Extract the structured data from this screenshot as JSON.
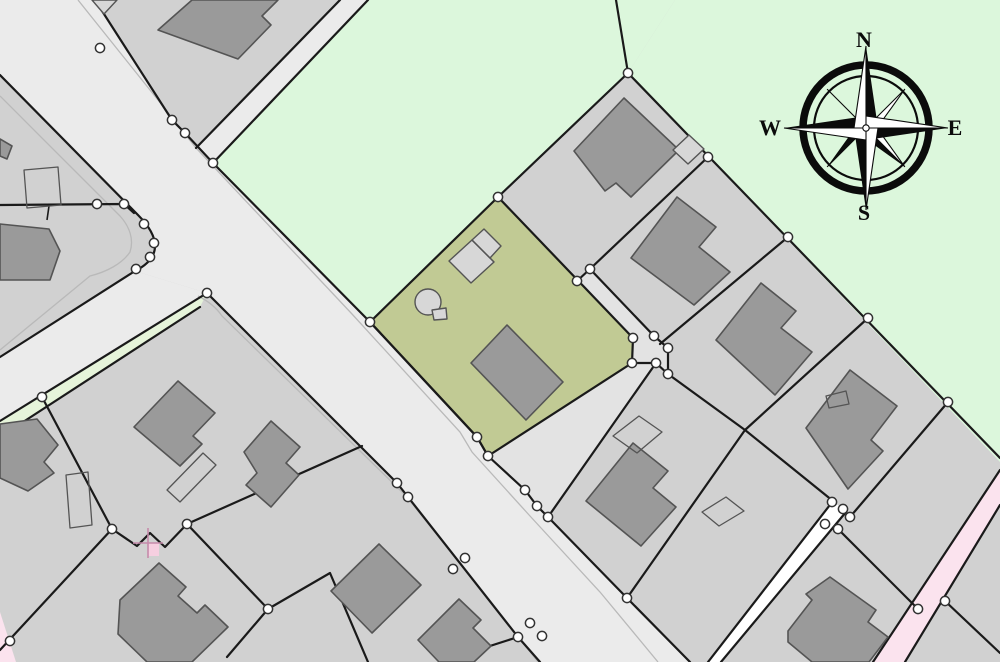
{
  "map": {
    "compass": {
      "north": "N",
      "east": "E",
      "south": "S",
      "west": "W"
    },
    "colors": {
      "parcel": "#d1d1d1",
      "parcel_line": "#1a1a1a",
      "field_green": "#dcf7dc",
      "verge_green": "#e6f4da",
      "selected_olive": "#c1ca94",
      "road": "#ebebeb",
      "lane": "#e3e3e3",
      "curb": "#b9b9b9",
      "building": "#9a9a9a",
      "building_line": "#545454",
      "building_light": "#d7d7d7",
      "path_white": "#ffffff",
      "road_pink": "#fbe3ee",
      "marker_pink": "#f6cfe0",
      "marker_pink_line": "#c58bab",
      "node_fill": "#ffffff",
      "node_line": "#333333",
      "compass_ink": "#0b0b0b"
    }
  }
}
